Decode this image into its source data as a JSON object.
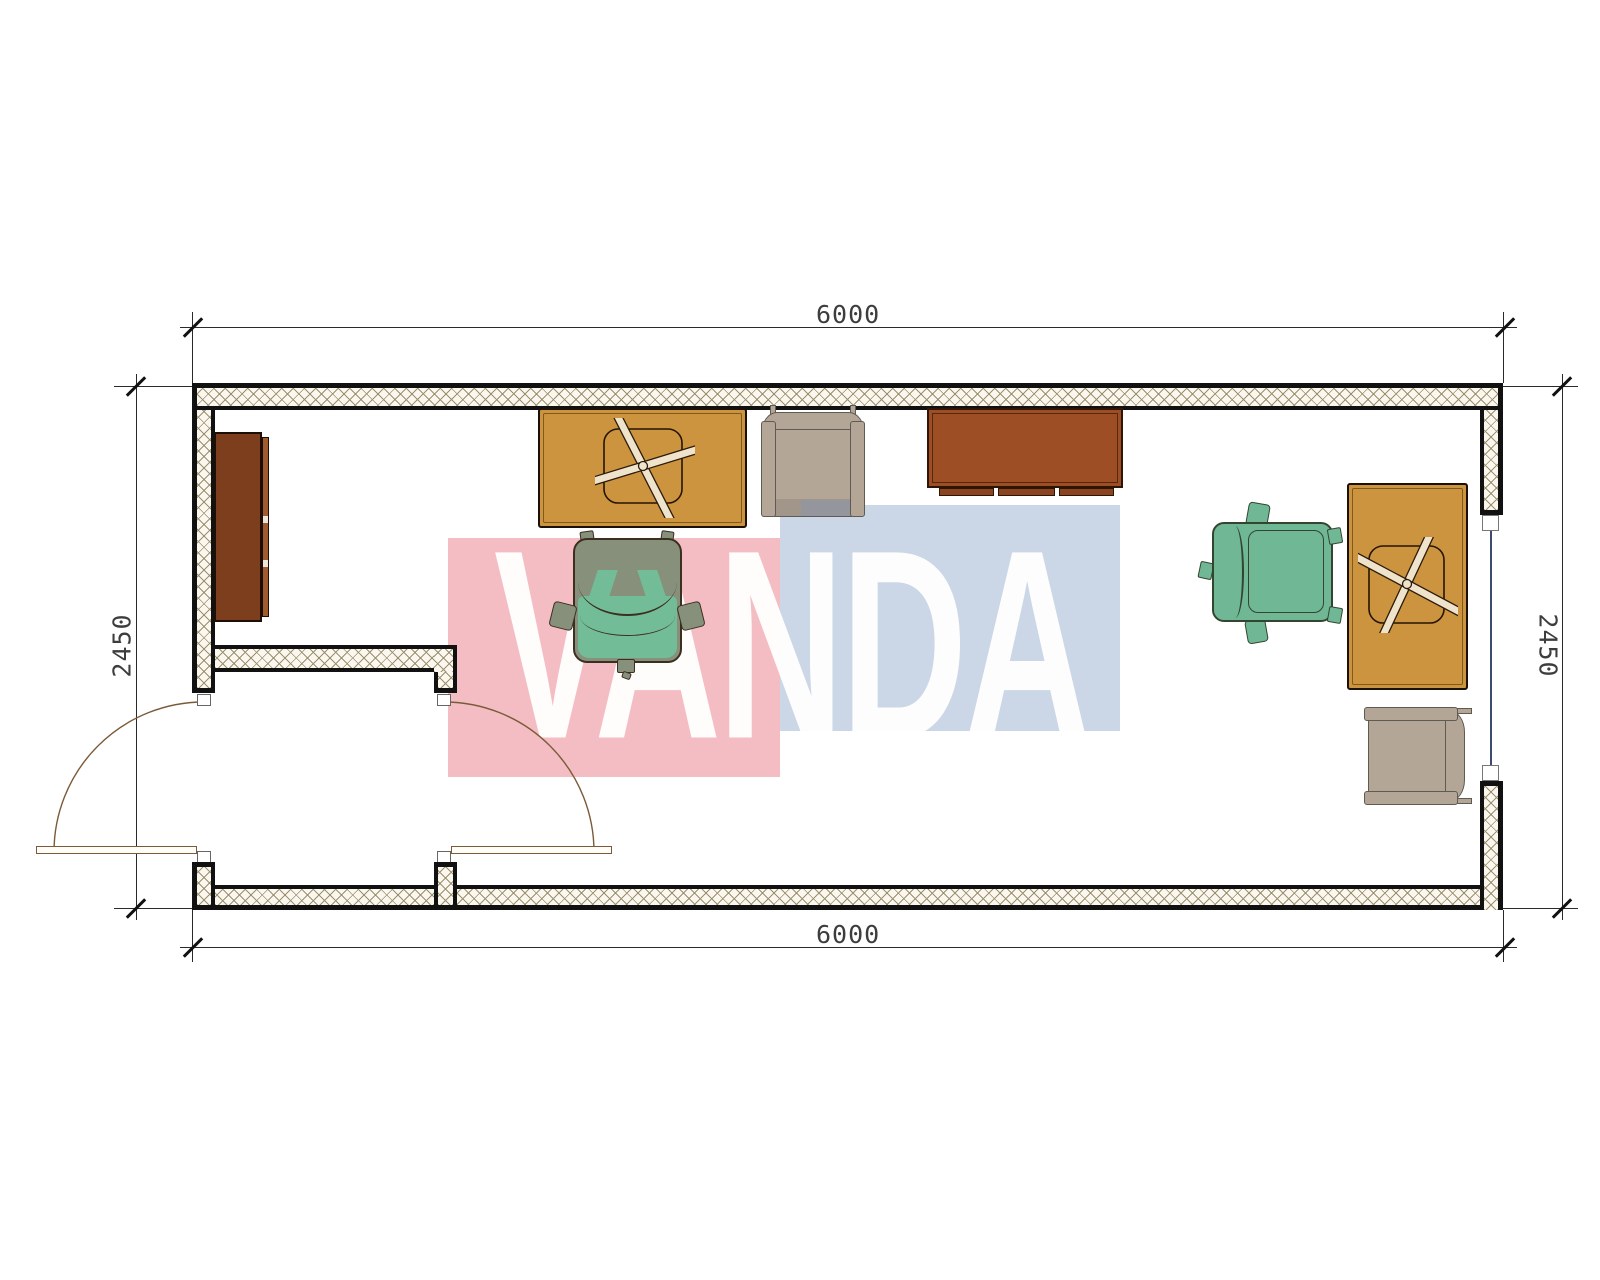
{
  "drawing": {
    "title": "container office floor plan",
    "dimensions": {
      "top_width": "6000",
      "bottom_width": "6000",
      "left_height": "2450",
      "right_height": "2450"
    },
    "watermark": {
      "text": "VANDA",
      "pink_block_color": "#f4bdc3",
      "blue_block_color": "#cbd7e6",
      "letter_color": "#ffffff"
    },
    "colors": {
      "wall_hatch_line": "#99906f",
      "wall_hatch_background": "#fbf7ee",
      "wall_edge": "#111111",
      "desk_orange": "#cd9440",
      "desk_brown": "#9d4e24",
      "cabinet_brown": "#7d3e1d",
      "chair_beige": "#b3a697",
      "chair_olive": "#87907b",
      "chair_teal": "#73bc98",
      "chair_green": "#6fb795",
      "window_glazing": "#3c4a6e",
      "door_line": "#7a5a38",
      "dimension_line": "#2a2a2a",
      "dimension_text": "#3d3d3d"
    },
    "elements": [
      {
        "id": "cabinet-left",
        "label": "sideboard cabinet"
      },
      {
        "id": "desk-top",
        "label": "office desk with x-base chair"
      },
      {
        "id": "armchair-top",
        "label": "upholstered armchair"
      },
      {
        "id": "desk-meeting",
        "label": "brown desk"
      },
      {
        "id": "office-chair-middle",
        "label": "swivel office chair"
      },
      {
        "id": "office-chair-right",
        "label": "swivel office chair"
      },
      {
        "id": "desk-right",
        "label": "office desk with x-base chair"
      },
      {
        "id": "armchair-right",
        "label": "upholstered armchair"
      },
      {
        "id": "double-door",
        "label": "double entry door"
      },
      {
        "id": "window-right",
        "label": "window"
      }
    ]
  }
}
